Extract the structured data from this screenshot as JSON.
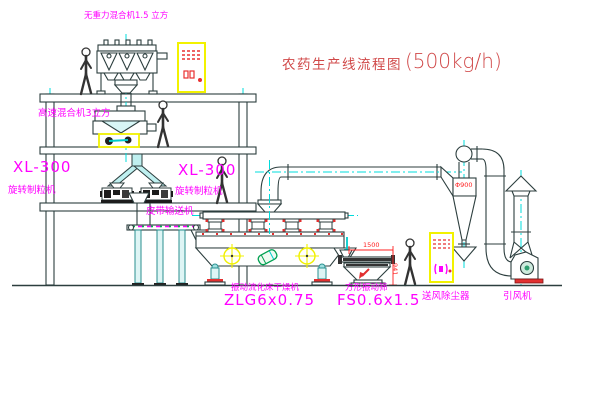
{
  "title": {
    "main": "农药生产线流程图",
    "capacity": "(500kg/h)"
  },
  "labels": {
    "gravity_mixer": "无重力混合机1.5 立方",
    "high_speed_mixer": "高速混合机3立方",
    "granulator_left": {
      "model": "XL-300",
      "name": "旋转制粒机"
    },
    "granulator_right": {
      "model": "XL-300",
      "name": "旋转制粒机"
    },
    "belt_conveyor": "皮带输送机",
    "fluid_bed_dryer": {
      "name": "振动流化床干燥机",
      "model": "ZLG6x0.75"
    },
    "vibrating_screen": {
      "name": "方形振动筛",
      "model": "FS0.6x1.5"
    },
    "dust_collector": "送风除尘器",
    "induced_draft_fan": "引风机"
  },
  "dimensions": {
    "screen_length": "1500",
    "screen_height": "941",
    "cyclone_diameter": "Φ900"
  },
  "colors": {
    "line": "#2c3e3e",
    "centerline_cyan": "#00dcdc",
    "label_magenta": "#ff00ff",
    "title_red": "#d04848",
    "dimension_red": "#ff2020",
    "cabinet_yellow": "#f2f200",
    "accent_green": "#00a050",
    "chute_cyan": "#bff0f0"
  }
}
